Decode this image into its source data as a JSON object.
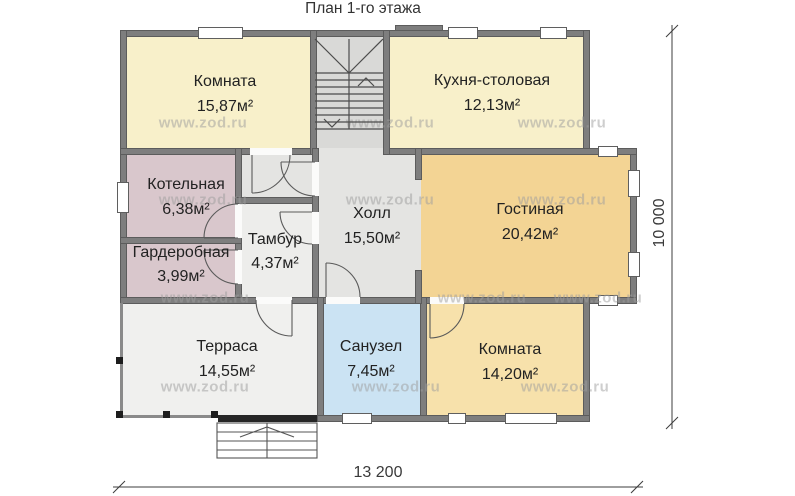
{
  "title": "План 1-го этажа",
  "watermark": "www.zod.ru",
  "rooms": [
    {
      "name": "Комната",
      "area": "15,87м²"
    },
    {
      "name": "Кухня-столовая",
      "area": "12,13м²"
    },
    {
      "name": "Котельная",
      "area": "6,38м²"
    },
    {
      "name": "Гардеробная",
      "area": "3,99м²"
    },
    {
      "name": "Тамбур",
      "area": "4,37м²"
    },
    {
      "name": "Холл",
      "area": "15,50м²"
    },
    {
      "name": "Гостиная",
      "area": "20,42м²"
    },
    {
      "name": "Терраса",
      "area": "14,55м²"
    },
    {
      "name": "Санузел",
      "area": "7,45м²"
    },
    {
      "name": "Комната",
      "area": "14,20м²"
    }
  ],
  "dimensions": {
    "width": "13 200",
    "height": "10 000"
  },
  "colors": {
    "room_pale_yellow": "#f8f0ca",
    "room_mauve": "#d9c7cc",
    "living_tan": "#f3d494",
    "bedroom_yellow": "#f7e1ab",
    "bathroom_blue": "#cbe3f3",
    "hall_gray": "#e4e4e2",
    "stairs_gray": "#d9d9d7",
    "vestibule_gray": "#ededeb",
    "terrace_gray": "#f0f0ee",
    "wall_gray": "#7e7e7e"
  }
}
